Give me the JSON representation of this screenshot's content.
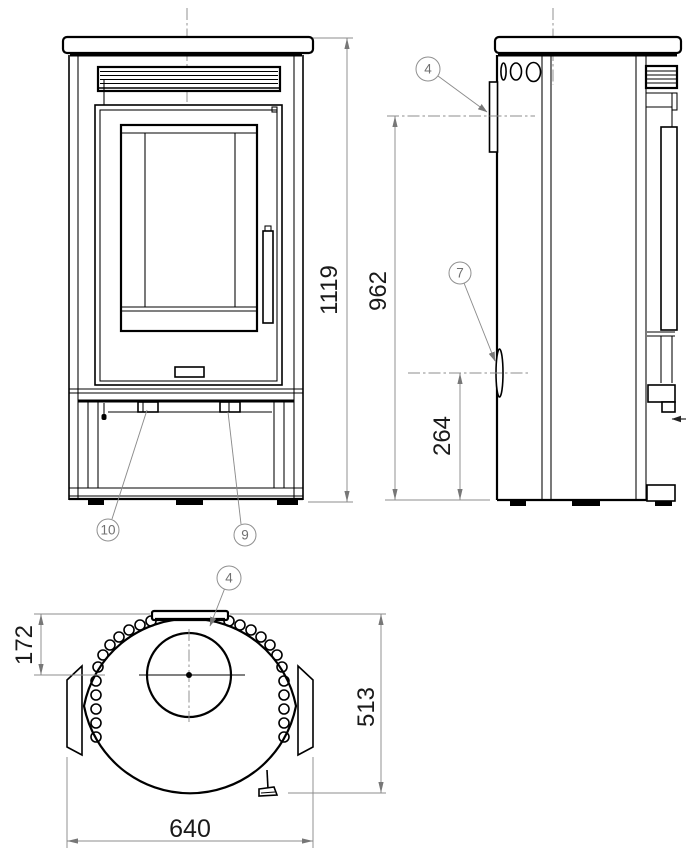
{
  "drawing": {
    "type": "technical-three-view-stove-drawing",
    "background": "#ffffff",
    "line_color": "#000000",
    "dimension_line_color": "#8c8c8c",
    "dimension_text_color": "#1a1a1a",
    "callout_color": "#707070"
  },
  "dimensions": {
    "overall_height": "1119",
    "flue_outlet_height": "962",
    "rear_inlet_height": "264",
    "flue_center_from_front": "172",
    "overall_depth": "513",
    "overall_width": "640"
  },
  "callouts": {
    "flue_outlet": "4",
    "rear_air_inlet": "7",
    "latch_right": "9",
    "latch_left": "10"
  }
}
